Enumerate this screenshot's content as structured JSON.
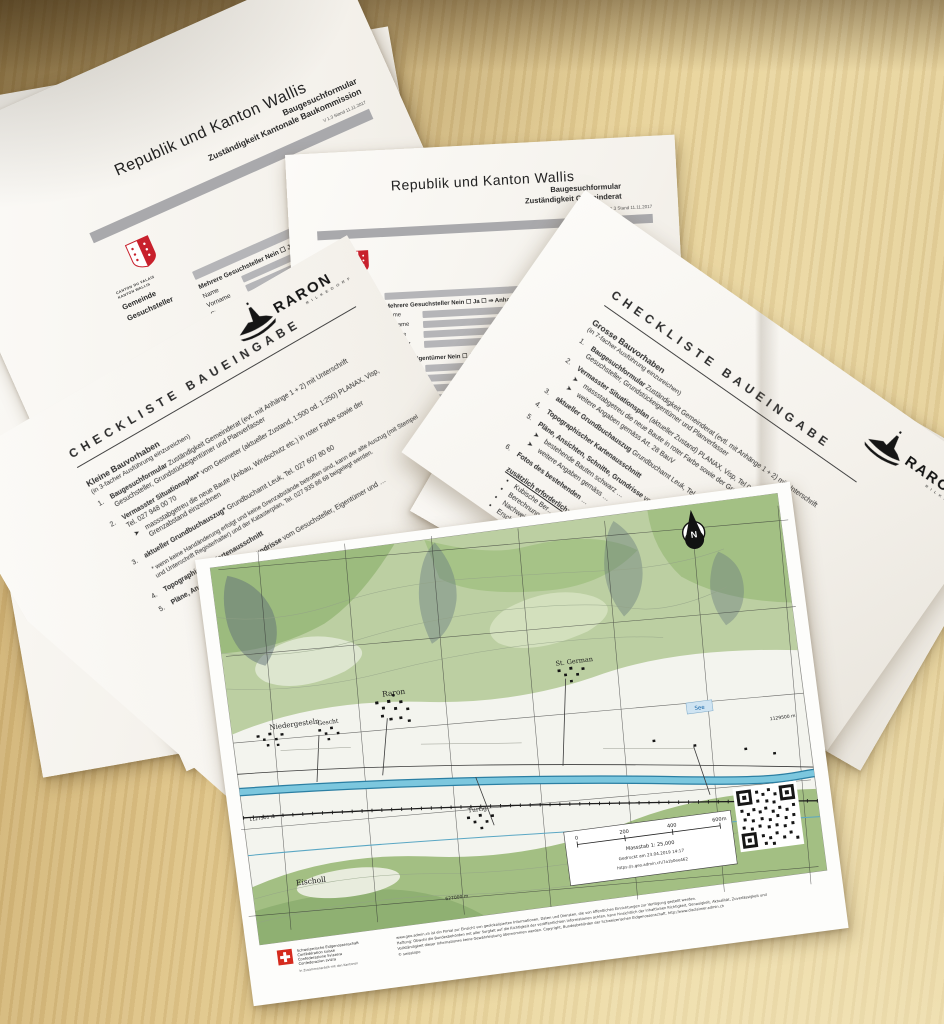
{
  "glyphs": {
    "arrow": "➤",
    "bullet": "•",
    "north": "N"
  },
  "raron_logo": {
    "name": "RARON",
    "tagline": "RILKEDORF"
  },
  "valais_logo": {
    "line1": "CANTON DU VALAIS",
    "line2": "KANTON WALLIS"
  },
  "form_kb": {
    "title": "Republik und Kanton Wallis",
    "subtitle1": "Baugesuchformular",
    "subtitle2": "Zuständigkeit Kantonale Baukommission",
    "version": "V 1.3 Stand 11.11.2017",
    "rail": [
      "Gemeinde",
      "Gesuchsteller",
      "Eigentümer"
    ],
    "mg_line": "Mehrere Gesuchsteller    Nein ☐     Ja ☐   ⇒  Anhang „A1“ beilegen",
    "me_line": "Mehrere Eigentümer     Nein ☐     Ja ☐   ⇒  Anhang „A2“ beilegen",
    "inhaber_line": "Inhaber eines and. dingl. Rechts (Baurecht, etc.)  Nein ☐     Ja ☐   ⇒  Nachweis beilegen",
    "left_fields": [
      "Name",
      "Vorname",
      "Strasse",
      "PLZ / Ort"
    ],
    "right_fields": [
      "Sohn/Tochter des",
      "Geboren am",
      "Telefon/Natel",
      "E-mail"
    ]
  },
  "form_gr": {
    "title": "Republik und Kanton Wallis",
    "subtitle1": "Baugesuchformular",
    "subtitle2": "Zuständigkeit Gemeinderat",
    "version": "V 1.3 Stand 11.11.2017",
    "rail": [
      "Gemeinde",
      "Gesuchsteller",
      "Eigentümer",
      "Planverfasser"
    ],
    "mg_line": "Mehrere Gesuchsteller    Nein ☐     Ja ☐   ⇒  Anhang „A1“ beilegen",
    "me_line": "Mehrere Eigentümer     Nein ☐     Ja ☐   ⇒  Anhang „A2“ beilegen",
    "inhaber_line": "Inhaber eines and. dingl. Rechts (Baurecht, etc.)  Nein ☐     Ja ☐   ⇒  Nachweis beilegen    Kataster-Nr.",
    "left_fields": [
      "Name",
      "Vorname",
      "Strasse",
      "PLZ / Ort"
    ],
    "right_fields": [
      "Sohn/Tochter des",
      "Geboren am",
      "Telefon/Natel",
      "E-mail"
    ],
    "buero_fields": [
      "Büro",
      "Name",
      "Vorname",
      "Strasse",
      "PLZ / Ort"
    ],
    "art40_line": "…igung gemäss Art. 40 BauG   Ja ☐    Nein ☐   ⇒  …",
    "plan_line": "…plan     Nein ☐     Ja ☐   ⇒  Anhang „…“ beilegen",
    "misc_line": "…stoffe ist …"
  },
  "checklist_left": {
    "title": "Checkliste Baueingabe",
    "heading": "Kleine Bauvorhaben",
    "copies": "(in 3-facher Ausführung einzureichen)",
    "items": [
      {
        "num": "1.",
        "lead": "Baugesuchformular",
        "rest": " Zuständigkeit Gemeinderat (evt. mit Anhänge 1 + 2) mit Unterschrift Gesuchsteller, Grundstückeigentümer und Planverfasser"
      },
      {
        "num": "2.",
        "lead": "Vermasster Situationsplan*",
        "rest": " vom Geometer (aktueller Zustand, 1:500 od. 1:250) PLANAX, Visp, Tel. 027 948 00 70",
        "sub": [
          "massstabgetreu die neue Baute (Anbau, Windschutz etc.) in roter Farbe sowie der Grenzabstand einzeichnen"
        ]
      },
      {
        "num": "3.",
        "lead": "aktueller Grundbuchauszug*",
        "rest": " Grundbuchamt Leuk, Tel. 027 607 80 60"
      },
      {
        "num": "4.",
        "lead": "Topographischer Kartenausschnitt",
        "rest": ""
      },
      {
        "num": "5.",
        "lead": "Pläne, Ansichten, Schnitte, Grundrisse",
        "rest": " vom Gesuchsteller, Eigentümer und …"
      }
    ],
    "footnote": "* wenn keine Handänderung erfolgt und keine Grenzabstände betroffen sind, kann der alte Auszug (mit Stempel und Unterschrift Registerhalter) und der Katasterplan, Tel. 027 935 86 68 beigelegt werden."
  },
  "checklist_right": {
    "title": "Checkliste Baueingabe",
    "heading": "Grosse Bauvorhaben",
    "copies": "(in 7-facher Ausführung einzureichen)",
    "items": [
      {
        "num": "1.",
        "lead": "Baugesuchformular",
        "rest": " Zuständigkeit Gemeinderat (evtl. mit Anhänge 1 + 2) mit Unterschrift Gesuchsteller, Grundstückeigentümer und Planverfasser"
      },
      {
        "num": "2.",
        "lead": "Vermasster Situationsplan",
        "rest": " (aktueller Zustand) PLANAX, Visp, Tel 027 948 00 70",
        "sub": [
          "massstabgetreu die neue Baute in roter Farbe sowie der Grenzabstand einzeichnen",
          "weitere Angaben gemäss Art. 28 BauV"
        ]
      },
      {
        "num": "3.",
        "lead": "aktueller Grundbuchauszug",
        "rest": " Grundbuchamt Leuk, Tel. 027 607 80 60"
      },
      {
        "num": "4.",
        "lead": "Topographischer Kartenausschnitt",
        "rest": ""
      },
      {
        "num": "5.",
        "lead": "Pläne, Ansichten, Schnitte, Grundrisse",
        "rest": " vom Gesuchsteller, Eigentümer und …",
        "sub": [
          "bestehende Bauten schwarz …",
          "weitere Angaben gemäss …"
        ]
      },
      {
        "num": "6.",
        "lead": "Fotos des bestehenden",
        "rest": " …"
      }
    ],
    "extra_heading": "zusätzlich erforderlich:",
    "extra": [
      "Kubische Ber…",
      "Berechnung …",
      "Nachweis …",
      "Ersch…"
    ],
    "fragment_behind": "…roter Farbe"
  },
  "map": {
    "places": {
      "niedergesteln": "Niedergesteln",
      "gescht": "Gescht",
      "raron": "Raron",
      "st_german": "St. German",
      "turtig": "Turtig",
      "eischoll": "Eischoll",
      "see": "See"
    },
    "coords": {
      "right": "1129500 m",
      "left": "1127500 m",
      "bottom": "627000 m"
    },
    "scalebox": {
      "ticks": [
        "0",
        "200",
        "400",
        "600m"
      ],
      "scale": "Massstab 1: 25,000",
      "printed": "Gedruckt am 23.04.2019 14:17",
      "url": "https://s.geo.admin.ch/7a1b0ee462"
    },
    "swiss_logo_lines": [
      "Schweizerische Eidgenossenschaft",
      "Confédération suisse",
      "Confederazione Svizzera",
      "Confederaziun svizra"
    ],
    "swiss_logo_sub": "In Zusammenarbeit mit den Kantonen",
    "disclaimer": [
      "www.geo.admin.ch ist ein Portal zur Einsicht von geolokalisierten Informationen, Daten und Diensten, die von öffentlichen Einrichtungen zur Verfügung gestellt werden.",
      "Haftung: Obwohl die Bundesbehörden mit aller Sorgfalt auf die Richtigkeit der veröffentlichten Informationen achten, kann hinsichtlich der inhaltlichen Richtigkeit, Genauigkeit, Aktualität, Zuverlässigkeit und",
      "Vollständigkeit dieser Informationen keine Gewährleistung übernommen werden. Copyright, Bundesbehörden der Schweizerischen Eidgenossenschaft. http://www.disclaimer.admin.ch",
      "© swisstopo"
    ]
  }
}
